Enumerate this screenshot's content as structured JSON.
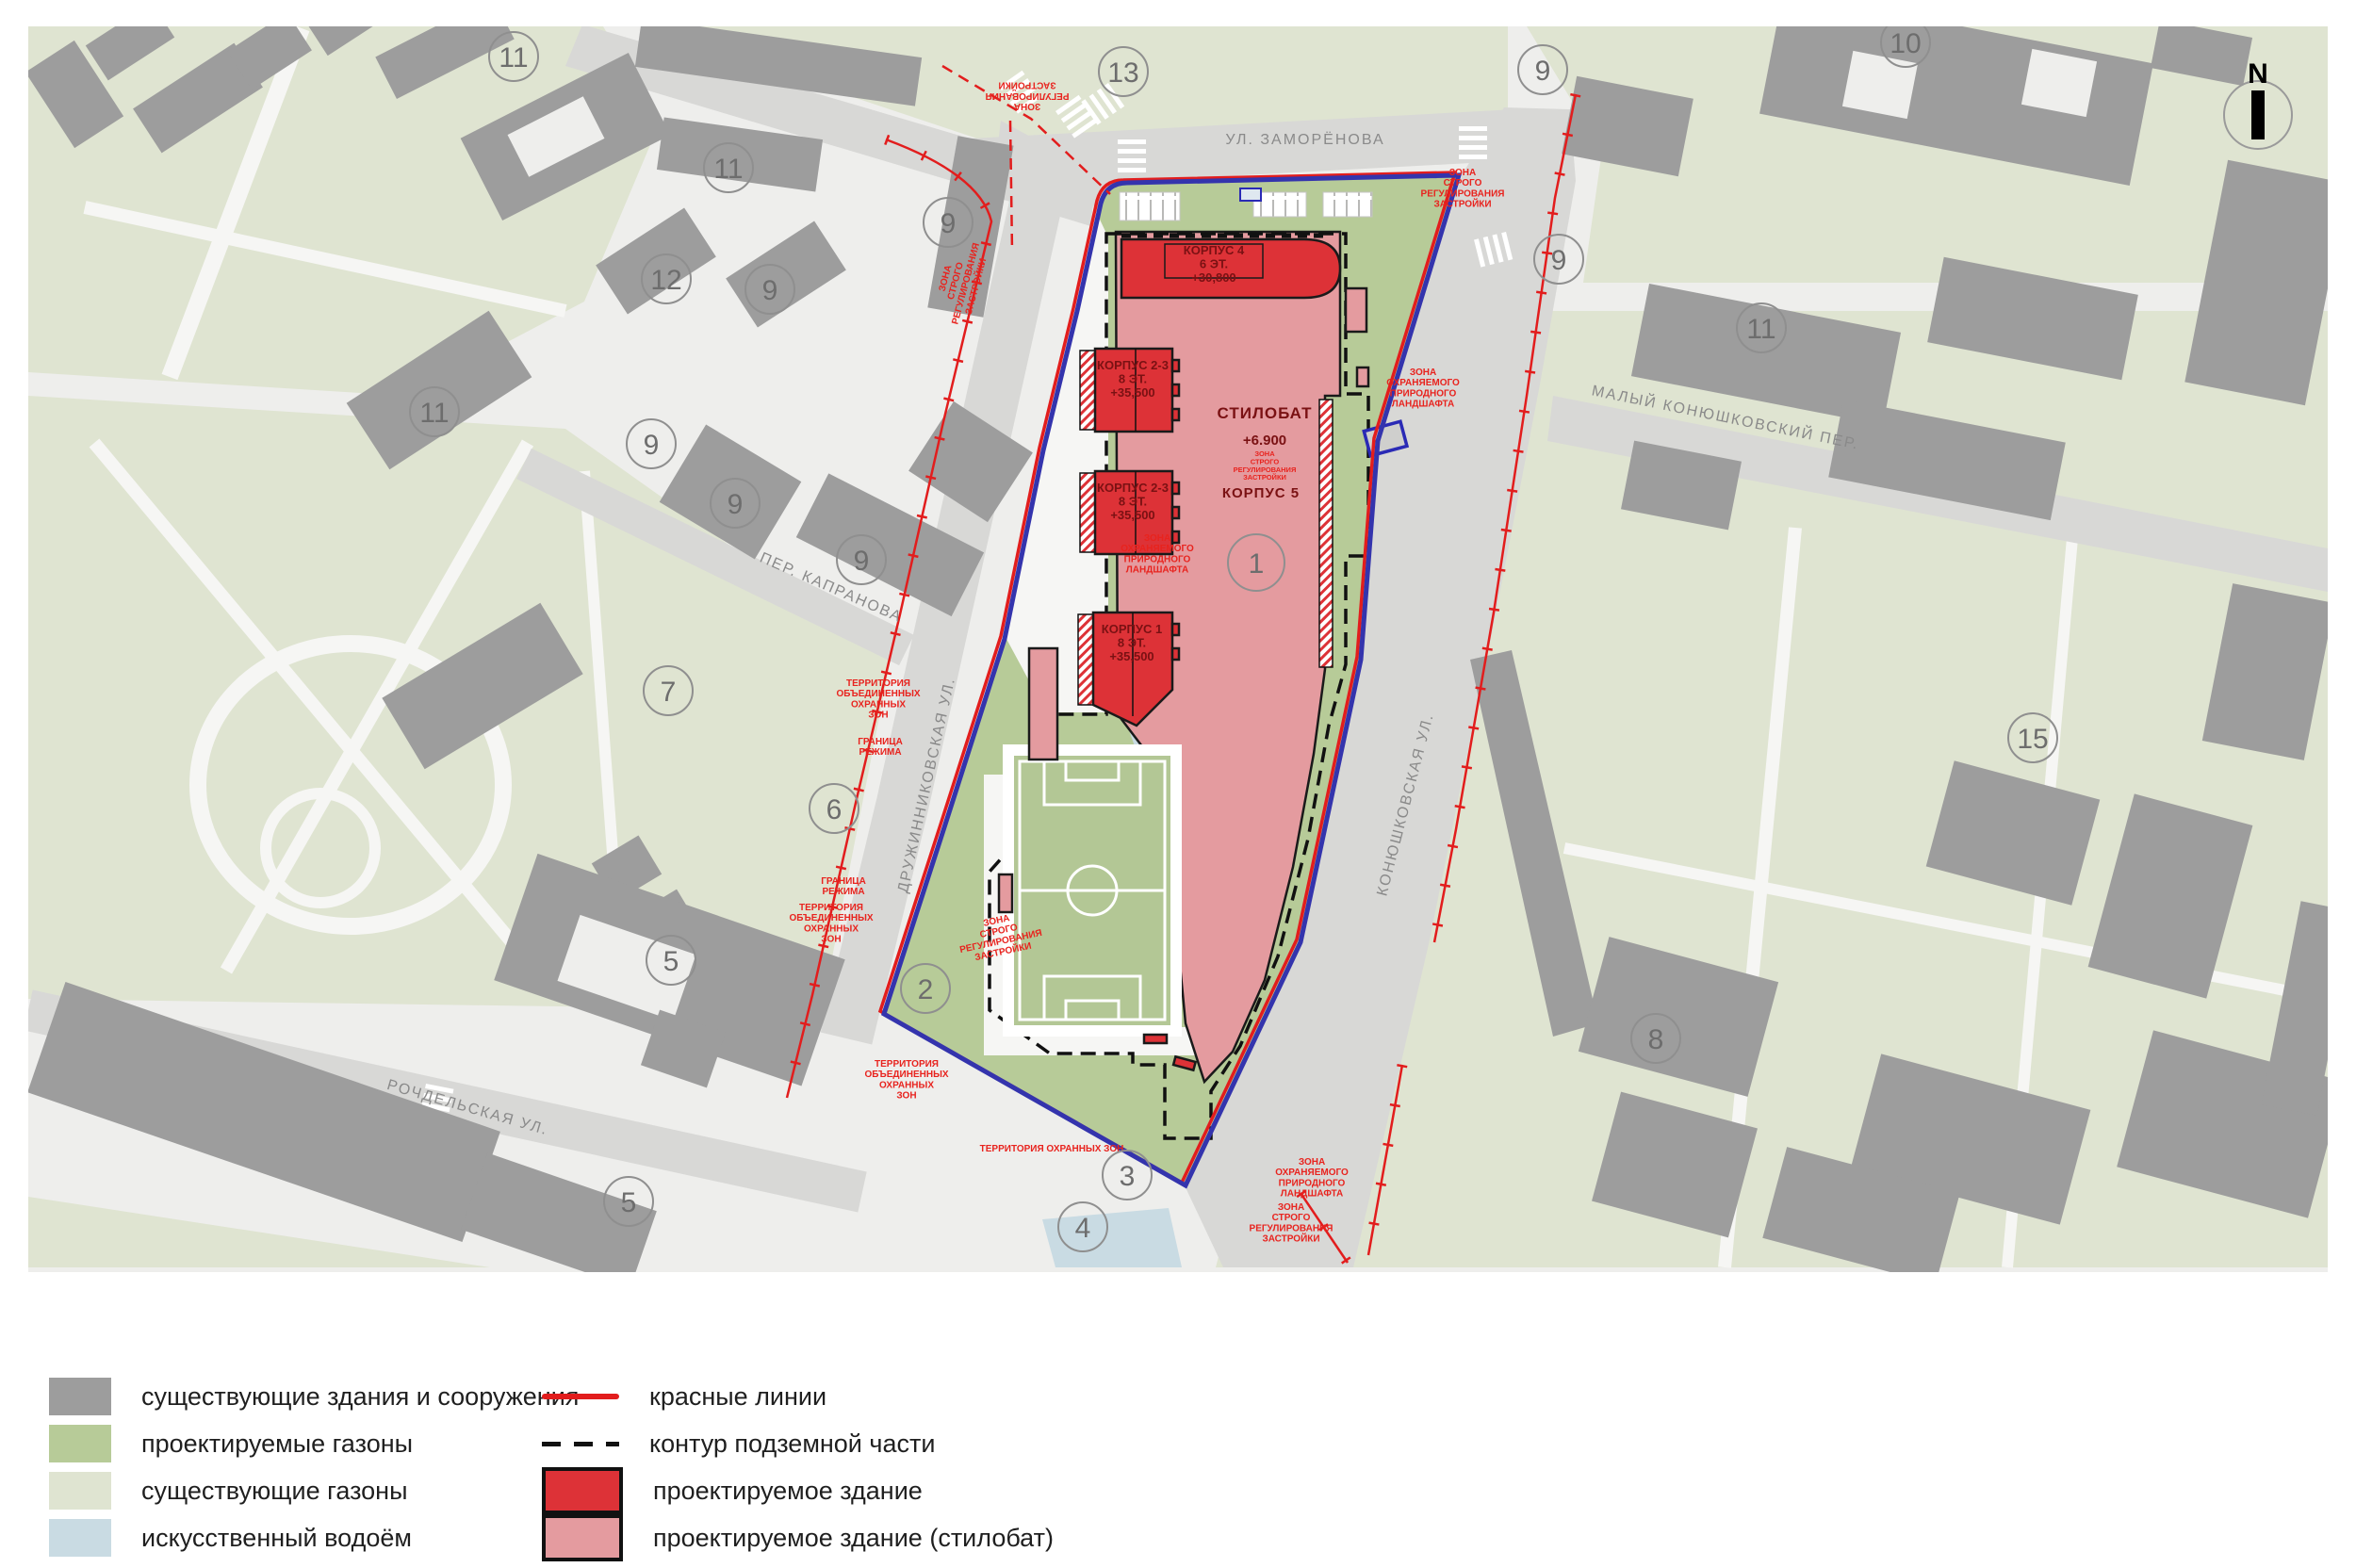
{
  "map": {
    "north_label": "N",
    "streets": {
      "zamorenova": "УЛ. ЗАМОРЁНОВА",
      "maly_konyushkovsky": "МАЛЫЙ КОНЮШКОВСКИЙ ПЕР.",
      "kapranova": "ПЕР. КАПРАНОВА",
      "konyushkovskaya": "КОНЮШКОВСКАЯ УЛ.",
      "druzhinnikovskaya": "ДРУЖИННИКОВСКАЯ УЛ.",
      "rochdelskaya": "РОЧДЕЛЬСКАЯ УЛ."
    },
    "buildings": {
      "korpus4": [
        "КОРПУС 4",
        "6 ЭТ.",
        "+30,800"
      ],
      "korpus23_upper": [
        "КОРПУС 2-3",
        "8 ЭТ.",
        "+35,500"
      ],
      "korpus23_lower": [
        "КОРПУС 2-3",
        "8 ЭТ.",
        "+35,500"
      ],
      "korpus1": [
        "КОРПУС 1",
        "8 ЭТ.",
        "+35,500"
      ],
      "stylobate_name": "СТИЛОБАТ",
      "stylobate_elev": "+6.900",
      "korpus5": "КОРПУС 5"
    },
    "zones": {
      "reg": [
        "ЗОНА",
        "РЕГУЛИРОВАНИЯ",
        "ЗАСТРОЙКИ"
      ],
      "strict": [
        "ЗОНА",
        "СТРОГО",
        "РЕГУЛИРОВАНИЯ",
        "ЗАСТРОЙКИ"
      ],
      "landscape": [
        "ЗОНА",
        "ОХРАНЯЕМОГО",
        "ПРИРОДНОГО",
        "ЛАНДШАФТА"
      ],
      "territory": [
        "ТЕРРИТОРИЯ",
        "ОБЪЕДИНЕННЫХ",
        "ОХРАННЫХ",
        "ЗОН"
      ],
      "territory_short": "ТЕРРИТОРИЯ ОХРАННЫХ ЗОН",
      "granica": [
        "ГРАНИЦА",
        "РЕЖИМА"
      ]
    },
    "markers": [
      {
        "n": "1"
      },
      {
        "n": "2"
      },
      {
        "n": "3"
      },
      {
        "n": "4"
      },
      {
        "n": "5"
      },
      {
        "n": "5"
      },
      {
        "n": "6"
      },
      {
        "n": "7"
      },
      {
        "n": "8"
      },
      {
        "n": "9"
      },
      {
        "n": "9"
      },
      {
        "n": "9"
      },
      {
        "n": "9"
      },
      {
        "n": "9"
      },
      {
        "n": "9"
      },
      {
        "n": "9"
      },
      {
        "n": "10"
      },
      {
        "n": "11"
      },
      {
        "n": "11"
      },
      {
        "n": "11"
      },
      {
        "n": "11"
      },
      {
        "n": "12"
      },
      {
        "n": "13"
      },
      {
        "n": "15"
      }
    ]
  },
  "legend": {
    "left": [
      {
        "label": "существующие здания и сооружения"
      },
      {
        "label": "проектируемые газоны"
      },
      {
        "label": "существующие газоны"
      },
      {
        "label": "искусственный водоём"
      }
    ],
    "right": [
      {
        "label": "красные линии"
      },
      {
        "label": "контур подземной части"
      },
      {
        "label": "проектируемое здание"
      },
      {
        "label": "проектируемое здание (стилобат)"
      }
    ]
  },
  "colors": {
    "existing_building": "#9d9d9d",
    "existing_lawn": "#dfe4d1",
    "projected_lawn": "#b7cb98",
    "pond": "#c9dbe3",
    "road": "#d8d8d6",
    "map_bg": "#eeeeec",
    "projected_building": "#dd3237",
    "stylobate": "#e49b9f",
    "boundary_blue": "#3434ad",
    "red_line": "#e21d1d",
    "korpus_label": "#7a1113",
    "zone_label": "#e8231e",
    "street_label": "#8a8a8a"
  }
}
